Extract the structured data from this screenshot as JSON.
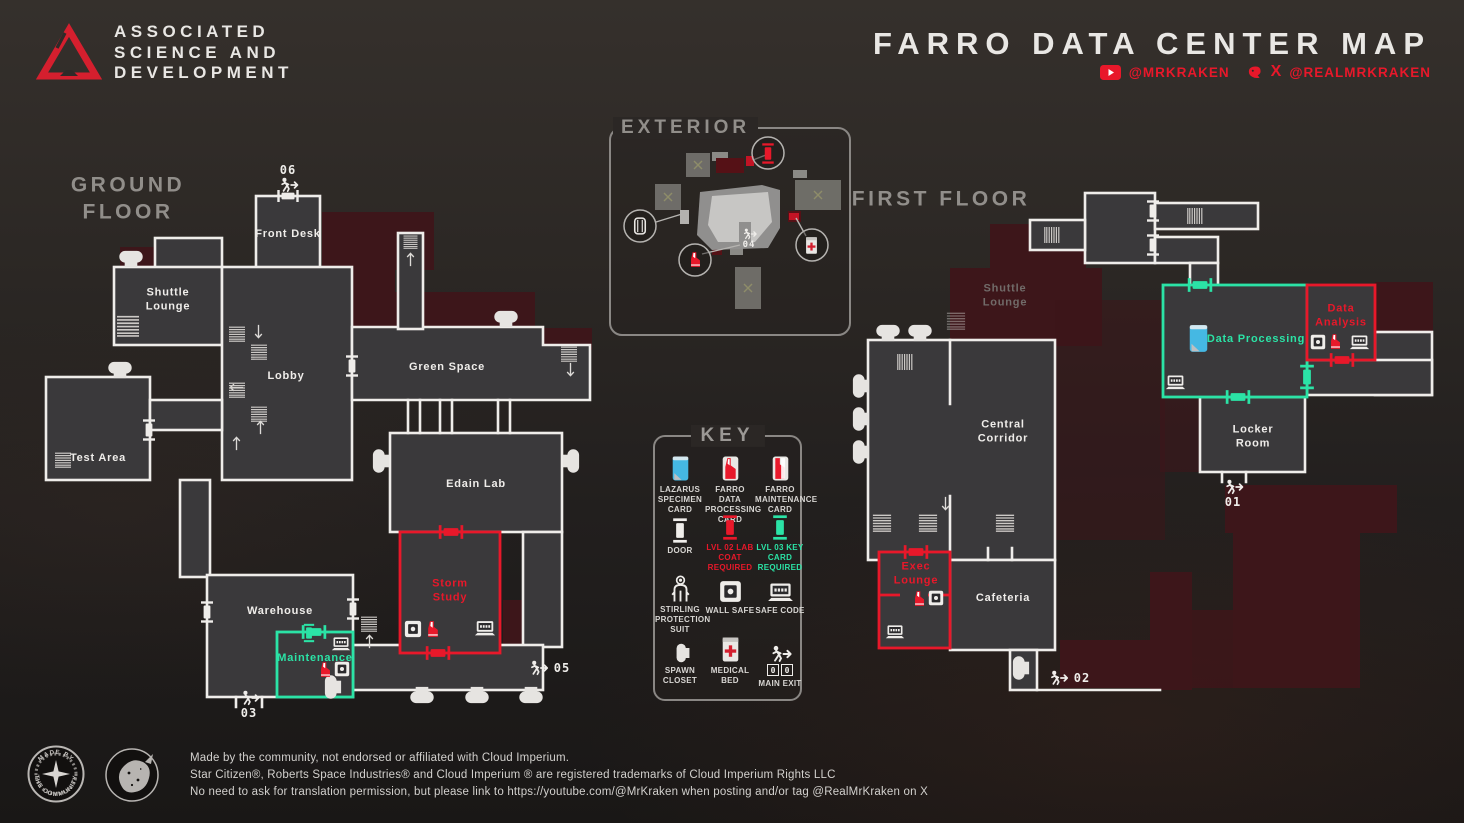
{
  "header": {
    "brand_line1": "ASSOCIATED",
    "brand_line2": "SCIENCE AND",
    "brand_line3": "DEVELOPMENT",
    "title": "FARRO DATA CENTER MAP",
    "youtube_handle": "@MRKRAKEN",
    "x_glyph": "X",
    "x_handle": "@REALMRKRAKEN"
  },
  "floors": {
    "ground_heading": "GROUND FLOOR",
    "first_heading": "FIRST FLOOR",
    "exterior_heading": "EXTERIOR"
  },
  "rooms": {
    "front_desk": "Front Desk",
    "shuttle_lounge_ground": "Shuttle Lounge",
    "lobby": "Lobby",
    "test_area": "Test Area",
    "green_space": "Green Space",
    "edain_lab": "Edain Lab",
    "storm_study": "Storm Study",
    "warehouse": "Warehouse",
    "maintenance": "Maintenance",
    "shuttle_lounge_first": "Shuttle Lounge",
    "central_corridor": "Central Corridor",
    "data_processing": "Data Processing",
    "data_analysis": "Data Analysis",
    "locker_room": "Locker Room",
    "exec_lounge": "Exec Lounge",
    "cafeteria": "Cafeteria"
  },
  "exits": {
    "e01": "01",
    "e02": "02",
    "e03": "03",
    "e04": "04",
    "e05": "05",
    "e06": "06"
  },
  "key": {
    "title": "KEY",
    "items": [
      {
        "label": "LAZARUS SPECIMEN CARD"
      },
      {
        "label": "FARRO DATA PROCESSING CARD"
      },
      {
        "label": "FARRO MAINTENANCE CARD"
      },
      {
        "label": "DOOR"
      },
      {
        "label": "LVL 02 LAB COAT REQUIRED"
      },
      {
        "label": "LVL 03 KEY CARD REQUIRED"
      },
      {
        "label": "STIRLING PROTECTION SUIT"
      },
      {
        "label": "WALL SAFE"
      },
      {
        "label": "SAFE CODE"
      },
      {
        "label": "SPAWN CLOSET"
      },
      {
        "label": "MEDICAL BED"
      },
      {
        "label": "MAIN EXIT",
        "code_digit_1": "0",
        "code_digit_2": "0"
      }
    ]
  },
  "colors": {
    "accent_red": "#E8182A",
    "accent_teal": "#2BE3A6",
    "card_blue": "#45B8E3",
    "wall_white": "#EFEDEA",
    "ghost_maroon": "#3D161A"
  },
  "footer": {
    "badge_top": "MADE BY",
    "badge_bottom": "THE COMMUNITY",
    "line1": "Made by the community, not endorsed or affiliated with Cloud Imperium.",
    "line2": "Star Citizen®, Roberts Space Industries® and Cloud Imperium ® are registered trademarks of Cloud Imperium Rights LLC",
    "line3": "No need to ask for translation permission, but please link to https://youtube.com/@MrKraken when posting and/or tag @RealMrKraken on X"
  }
}
